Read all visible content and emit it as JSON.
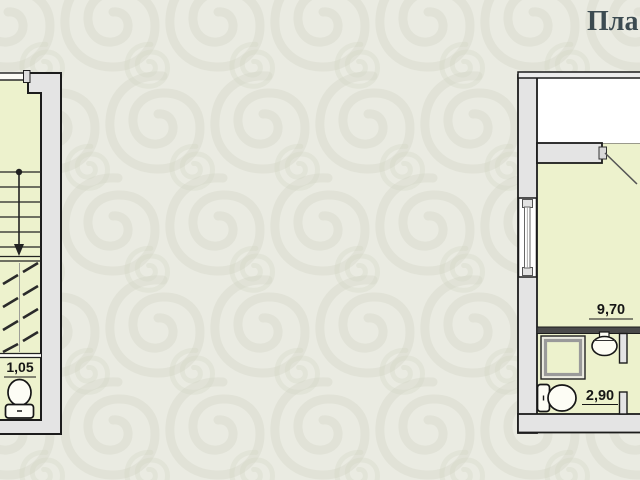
{
  "title": {
    "text": "Пла"
  },
  "left_plan": {
    "description": "stair-section-with-wc",
    "wc_area_label": "1,05"
  },
  "right_plan": {
    "description": "room-with-bathroom",
    "room_area_label": "9,70",
    "bath_area_label": "2,90"
  },
  "colors": {
    "background": "#eaebe2",
    "watermark": "#d3d5c4",
    "floor_green": "#edf2cd",
    "white_room": "#ffffff",
    "wall_fill": "#e4e4e4",
    "outline": "#1c1c1c",
    "title_color": "#3c4b51"
  }
}
